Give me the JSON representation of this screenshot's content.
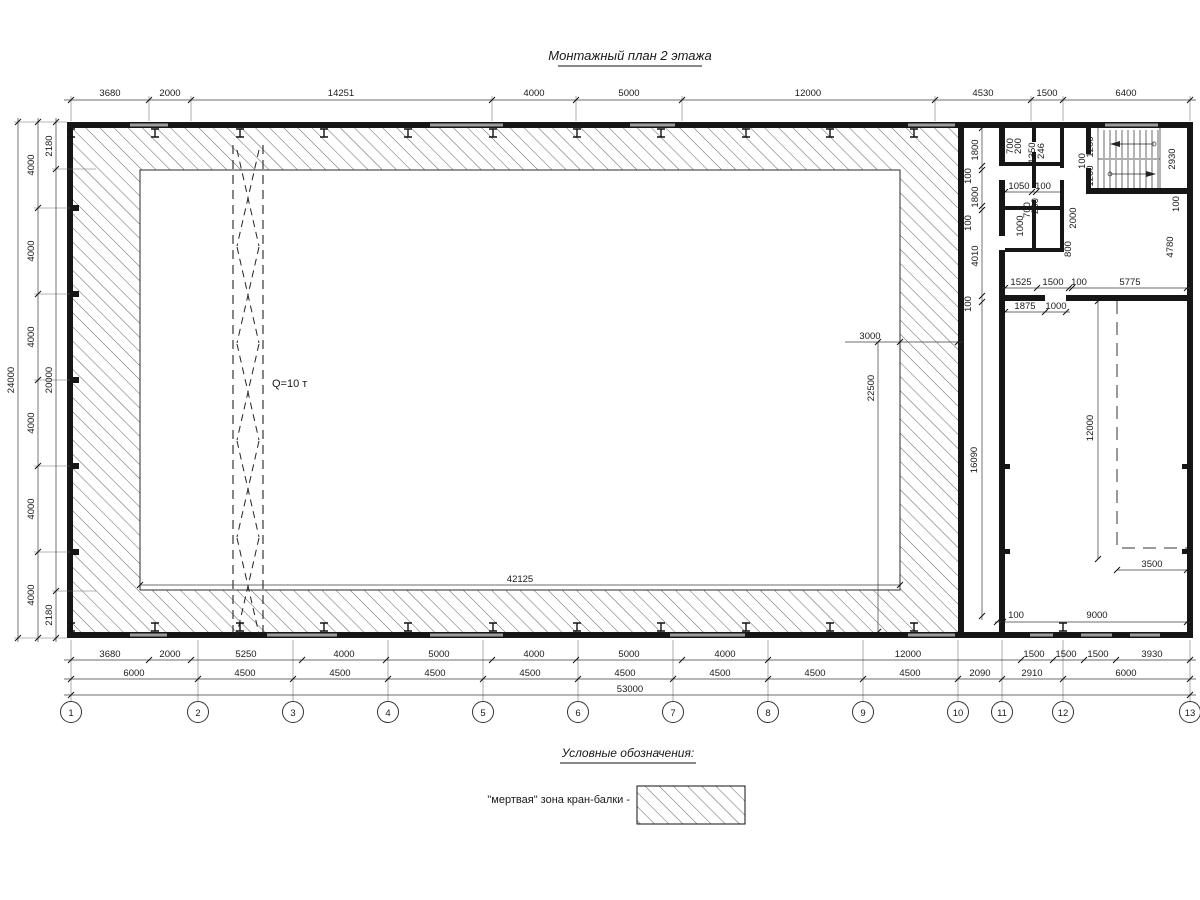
{
  "title": "Монтажный план 2 этажа",
  "legend": {
    "heading": "Условные обозначения:",
    "dead_zone_label": "\"мертвая\" зона кран-балки -"
  },
  "hall": {
    "crane_capacity": "Q=10 т",
    "crane_zone_width": "42125",
    "dead_zone_width": "3000",
    "crane_zone_height": "22500"
  },
  "dims": {
    "top": [
      "3680",
      "2000",
      "14251",
      "4000",
      "5000",
      "12000",
      "4530",
      "1500",
      "6400"
    ],
    "left_total": "24000",
    "left_spans": [
      "4000",
      "4000",
      "4000",
      "4000",
      "4000",
      "4000"
    ],
    "left_inner": [
      "2180",
      "20000",
      "2180"
    ],
    "bottom_row1": [
      "3680",
      "2000",
      "5250",
      "4000",
      "5000",
      "4000",
      "5000",
      "4000",
      "12000",
      "1500",
      "1500",
      "1500",
      "3930"
    ],
    "bottom_row2": [
      "6000",
      "4500",
      "4500",
      "4500",
      "4500",
      "4500",
      "4500",
      "4500",
      "4500",
      "2090",
      "2910",
      "6000"
    ],
    "bottom_total": "53000"
  },
  "grid_labels": [
    "1",
    "2",
    "3",
    "4",
    "5",
    "6",
    "7",
    "8",
    "9",
    "10",
    "11",
    "12",
    "13"
  ],
  "annex": {
    "left_col": [
      "1800",
      "100",
      "1800",
      "100",
      "4010",
      "100"
    ],
    "wing_height": "16090",
    "toilet": [
      "700",
      "200",
      "1350",
      "246",
      "1050",
      "100",
      "700",
      "200",
      "1000"
    ],
    "stair": [
      "1200",
      "100",
      "1200",
      "2930",
      "100",
      "4780",
      "2000",
      "800"
    ],
    "mid_row": [
      "1525",
      "1500",
      "100",
      "5775"
    ],
    "mid_row2": [
      "1875",
      "1000"
    ],
    "room": [
      "12000",
      "3500",
      "100",
      "9000"
    ]
  }
}
